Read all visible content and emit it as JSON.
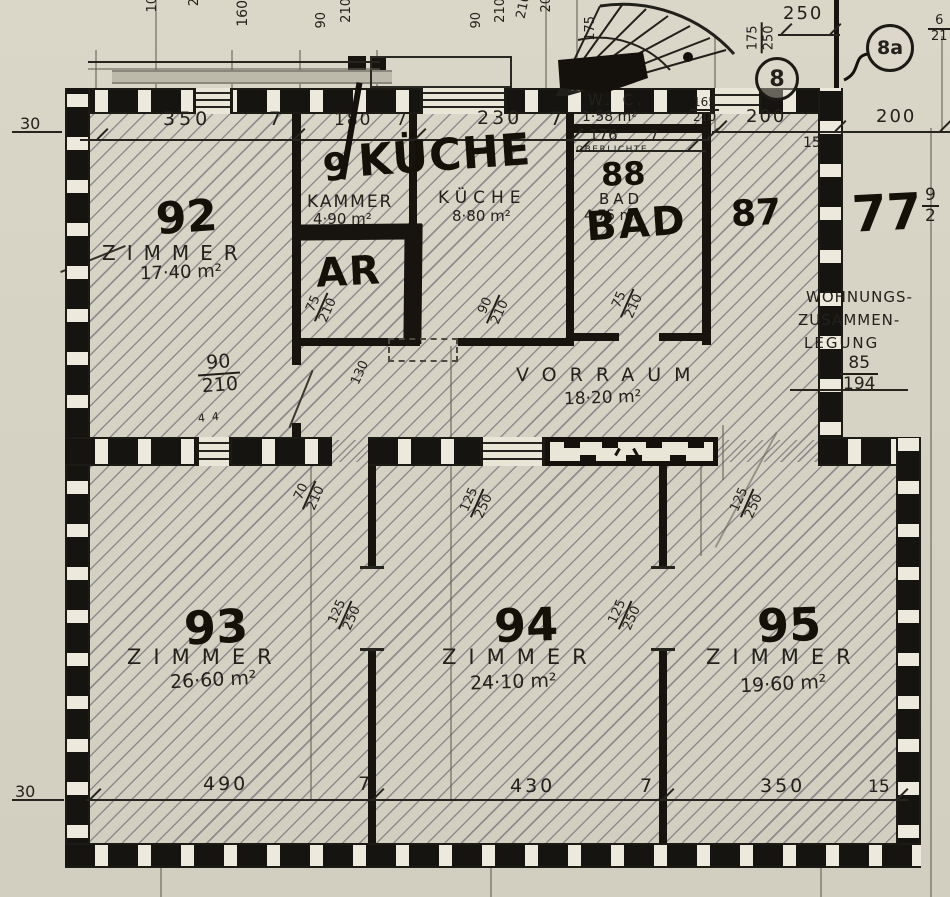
{
  "plan": {
    "rooms": {
      "z92": {
        "no": "92",
        "name": "ZIMMER",
        "area": "17·40 m²"
      },
      "kammer": {
        "name": "KAMMER",
        "area": "4·90 m²"
      },
      "kueche": {
        "name": "KÜCHE",
        "area": "8·80 m²"
      },
      "wc": {
        "name": "W. C.",
        "area": "1·58 m²"
      },
      "bad": {
        "no": "88",
        "name": "BAD",
        "area": "4·75 m²"
      },
      "vorraum": {
        "name": "VORRAUM",
        "area": "18·20 m²"
      },
      "z93": {
        "no": "93",
        "name": "ZIMMER",
        "area": "26·60 m²"
      },
      "z94": {
        "no": "94",
        "name": "ZIMMER",
        "area": "24·10 m²"
      },
      "z95": {
        "no": "95",
        "name": "ZIMMER",
        "area": "19·60 m²"
      }
    },
    "marker": {
      "nine": "9",
      "kueche": "KÜCHE",
      "ar": "AR",
      "bad": "BAD",
      "n87": "87",
      "n77": "77"
    },
    "dims": {
      "top": [
        "350",
        "7",
        "180",
        "7",
        "230",
        "7"
      ],
      "wc_width": "176",
      "wc_wall": "7",
      "right": [
        "200",
        "200"
      ],
      "right_15": "15",
      "right_250": "250",
      "bottom": [
        "490",
        "7",
        "430",
        "7",
        "350",
        "15"
      ],
      "wall_30_top": "30",
      "wall_30_bottom": "30",
      "edge_top": [
        "10",
        "2",
        "160",
        "90",
        "210",
        "90",
        "210",
        "210",
        "20"
      ],
      "stair_175": "175",
      "note_44": "4  4",
      "note_130": "130"
    },
    "openings": {
      "entry_stair": {
        "w": "165",
        "h": "210"
      },
      "stiege": {
        "w": "175",
        "h": "250"
      },
      "door_z92": {
        "w": "90",
        "h": "210"
      },
      "door_kueche": {
        "w": "90",
        "h": "210"
      },
      "door_bad": {
        "w": "75",
        "h": "210"
      },
      "door_ar": {
        "w": "75",
        "h": "210"
      },
      "door_z93": {
        "w": "70",
        "h": "210"
      },
      "win_125": {
        "w": "125",
        "h": "250"
      }
    },
    "fractions": {
      "f85": {
        "top": "85",
        "bottom": "194"
      },
      "f9": {
        "top": "9",
        "bottom": "2"
      },
      "f6": {
        "top": "6",
        "bottom": "21"
      }
    },
    "notes": {
      "oberlichte": "OBERLICHTE",
      "merge1": "WOHNUNGS-",
      "merge2": "ZUSAMMEN-",
      "merge3": "LEGUNG"
    },
    "circles": {
      "c8": "8",
      "c8a": "8a"
    }
  }
}
